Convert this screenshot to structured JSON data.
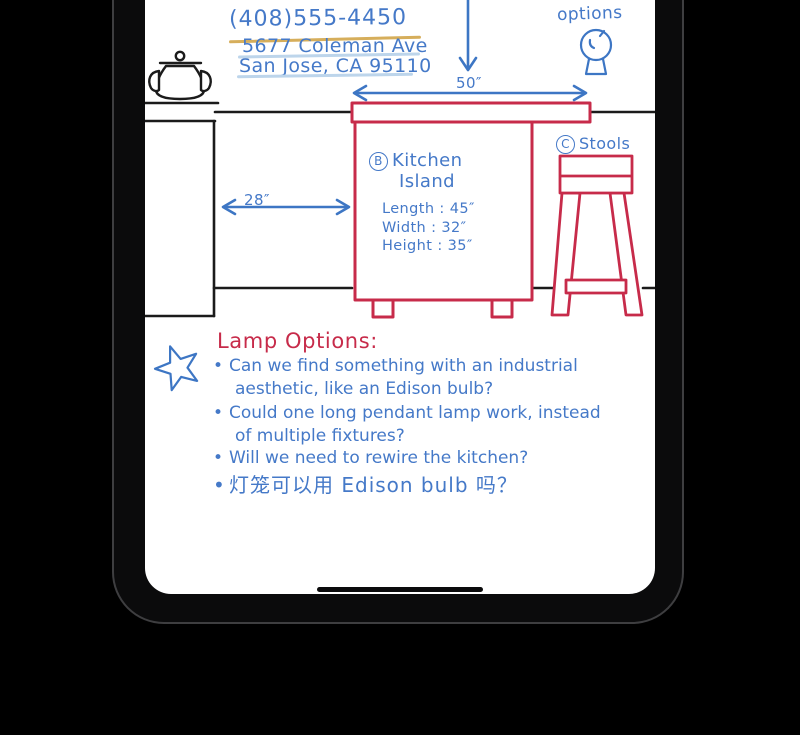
{
  "device": {
    "type": "tablet",
    "home_indicator": "drag-handle"
  },
  "note": {
    "contact": {
      "phone": "(408)555-4450",
      "address_line1": "5677 Coleman Ave",
      "address_line2": "San Jose, CA 95110"
    },
    "annotations": {
      "options_label": "options",
      "top_width": "50″",
      "left_gap": "28″",
      "island": {
        "tag": "B",
        "title_line1": "Kitchen",
        "title_line2": "Island",
        "dims": [
          "Length : 45″",
          "Width : 32″",
          "Height : 35″"
        ]
      },
      "stools": {
        "tag": "C",
        "label": "Stools"
      }
    },
    "lamp_options": {
      "heading": "Lamp Options:",
      "lines": [
        {
          "marker": "•",
          "text": "Can we find something with an industrial"
        },
        {
          "marker": "",
          "text": "aesthetic, like an Edison bulb?"
        },
        {
          "marker": "•",
          "text": "Could one long pendant lamp work, instead"
        },
        {
          "marker": "",
          "text": "of multiple fixtures?"
        },
        {
          "marker": "•",
          "text": "Will we need to rewire the kitchen?"
        },
        {
          "marker": "•",
          "text": "灯笼可以用 Edison bulb 吗？"
        }
      ]
    },
    "colors": {
      "ink_blue": "#4579c8",
      "ink_red": "#c72b4a",
      "ink_black": "#1b1b1b",
      "underline_yellow": "#d6ae5b",
      "underline_light_blue": "#bdd5eb"
    }
  }
}
